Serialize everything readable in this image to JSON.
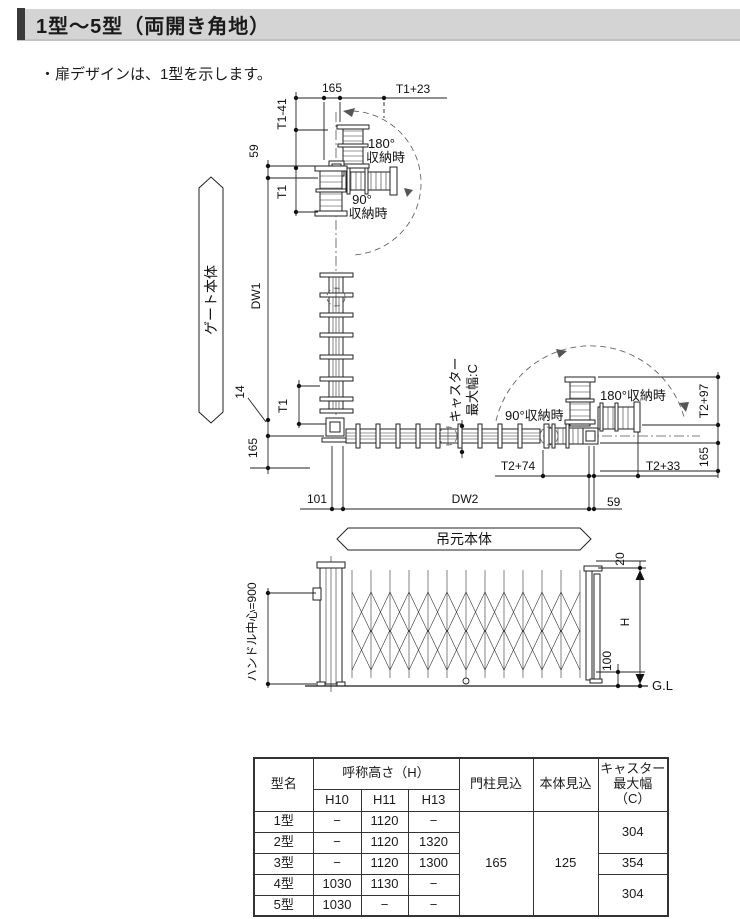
{
  "header": {
    "title": "1型～5型（両開き角地）"
  },
  "note": "・扉デザインは、1型を示します。",
  "plan": {
    "gate_body_banner": "ゲート本体",
    "hinge_body_banner": "吊元本体",
    "stow_180_upper_line1": "180°",
    "stow_180_upper_line2": "収納時",
    "stow_90_upper_line1": "90°",
    "stow_90_upper_line2": "収納時",
    "stow_90_lower": "90°収納時",
    "stow_180_lower": "180°収納時",
    "caster_label_line1": "キャスター",
    "caster_label_line2": "最大幅:C",
    "dims": {
      "top_165": "165",
      "t1_plus_23": "T1+23",
      "t1_minus_41": "T1-41",
      "left_59": "59",
      "t1_upper": "T1",
      "dw1": "DW1",
      "dim_14": "14",
      "t1_lower": "T1",
      "left_165": "165",
      "dim_101": "101",
      "dw2": "DW2",
      "bottom_59": "59",
      "t2_plus_74": "T2+74",
      "t2_plus_33": "T2+33",
      "t2_plus_97": "T2+97",
      "right_165": "165"
    }
  },
  "elevation": {
    "handle_center": "ハンドル中心=900",
    "dim_20": "20",
    "dim_h": "H",
    "dim_100": "100",
    "ground_line": "G.L"
  },
  "table": {
    "col_model": "型名",
    "col_height": "呼称高さ（H）",
    "sub_h10": "H10",
    "sub_h11": "H11",
    "sub_h13": "H13",
    "col_pillar": "門柱見込",
    "col_body": "本体見込",
    "caster_l1": "キャスター",
    "caster_l2": "最大幅",
    "caster_l3": "（C）",
    "pillar_value": "165",
    "body_value": "125",
    "caster_values": [
      "304",
      "354",
      "304"
    ],
    "rows": [
      {
        "model": "1型",
        "h10": "−",
        "h11": "1120",
        "h13": "−"
      },
      {
        "model": "2型",
        "h10": "−",
        "h11": "1120",
        "h13": "1320"
      },
      {
        "model": "3型",
        "h10": "−",
        "h11": "1120",
        "h13": "1300"
      },
      {
        "model": "4型",
        "h10": "1030",
        "h11": "1130",
        "h13": "−"
      },
      {
        "model": "5型",
        "h10": "1030",
        "h11": "−",
        "h13": "−"
      }
    ]
  }
}
